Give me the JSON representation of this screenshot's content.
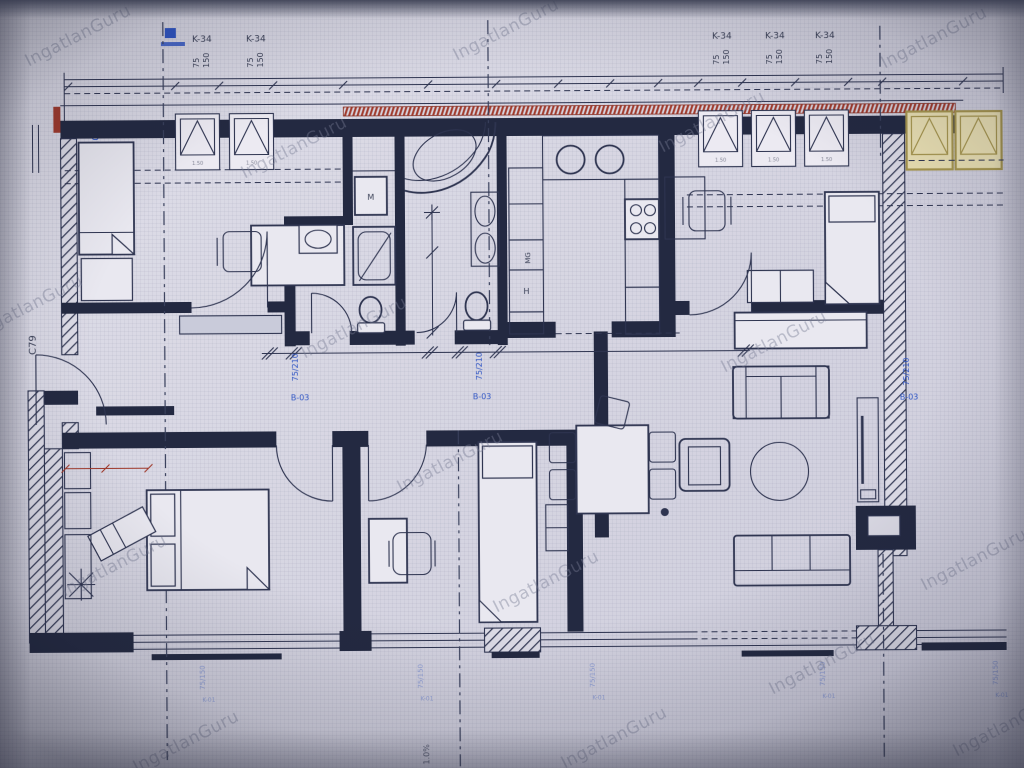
{
  "watermark": {
    "text": "IngatlanGuru"
  },
  "plan_labels": {
    "window_type": "K-34",
    "window_width": "75",
    "window_height": "150",
    "window_sill": "1.50",
    "door_size": "75/210",
    "door_type": "B-03",
    "level_mark": "p=4.00",
    "section_mark": "C79",
    "slope_mark": "1.0%",
    "washing_machine": "M",
    "dishwasher": "MG",
    "fridge": "H",
    "lower_window_size": "75/150",
    "lower_window_type": "K-01"
  },
  "colors": {
    "ink": "#2e3450",
    "wall": "#232941",
    "red": "#a03a2c",
    "yellow": "#a8974e",
    "yellow_fill": "#ece2b4",
    "blue": "#2f55c4",
    "paper": "#d8d7e2"
  }
}
